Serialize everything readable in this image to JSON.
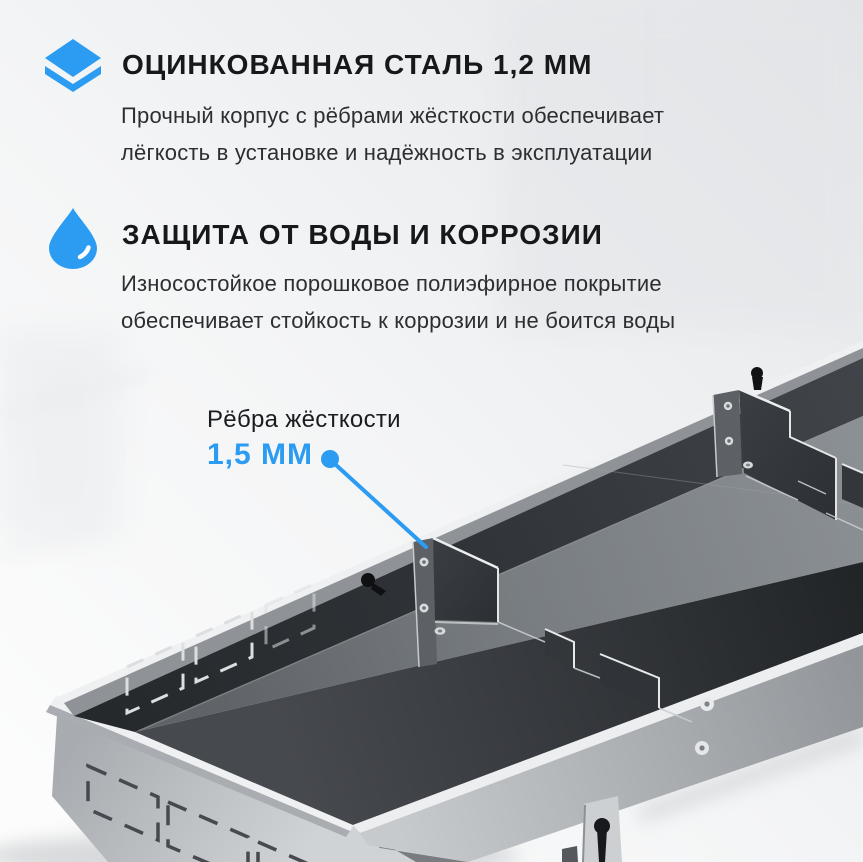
{
  "accent_color": "#2B9CF2",
  "features": [
    {
      "icon": "layers-icon",
      "title": "ОЦИНКОВАННАЯ СТАЛЬ 1,2 ММ",
      "description_lines": [
        "Прочный корпус с рёбрами жёсткости обеспечивает",
        "лёгкость в установке и надёжность в эксплуатации"
      ]
    },
    {
      "icon": "water-drop-icon",
      "title": "ЗАЩИТА ОТ ВОДЫ И КОРРОЗИИ",
      "description_lines": [
        "Износостойкое порошковое полиэфирное покрытие",
        "обеспечивает стойкость к коррозии и не боится воды"
      ]
    }
  ],
  "callout": {
    "label": "Рёбра жёсткости",
    "value": "1,5 ММ"
  }
}
